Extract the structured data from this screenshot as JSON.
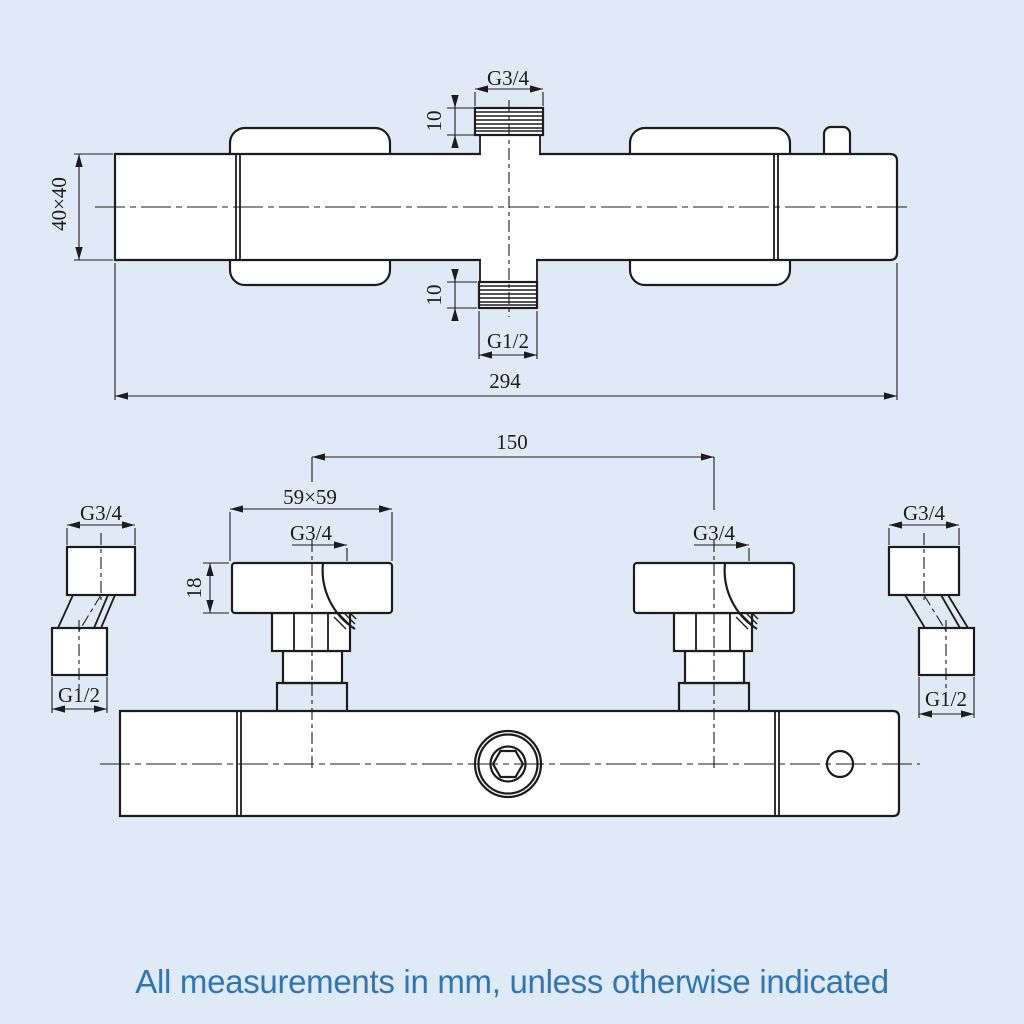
{
  "colors": {
    "background": "#e0eaf7",
    "line": "#1c1c1c",
    "note_text": "#2e76b5"
  },
  "top_view": {
    "dims": {
      "outlet_thread": "G3/4",
      "outlet_length": "10",
      "body_section": "40×40",
      "inlet_length": "10",
      "inlet_thread": "G1/2",
      "overall_length": "294"
    }
  },
  "front_view": {
    "dims": {
      "valve_spacing": "150",
      "handle_plate": "59×59",
      "plate_height": "18",
      "left_valve_thread": "G3/4",
      "right_valve_thread": "G3/4"
    },
    "left_fitting": {
      "top_thread": "G3/4",
      "bottom_thread": "G1/2"
    },
    "right_fitting": {
      "top_thread": "G3/4",
      "bottom_thread": "G1/2"
    }
  },
  "footer": {
    "note": "All measurements in mm, unless otherwise indicated"
  }
}
